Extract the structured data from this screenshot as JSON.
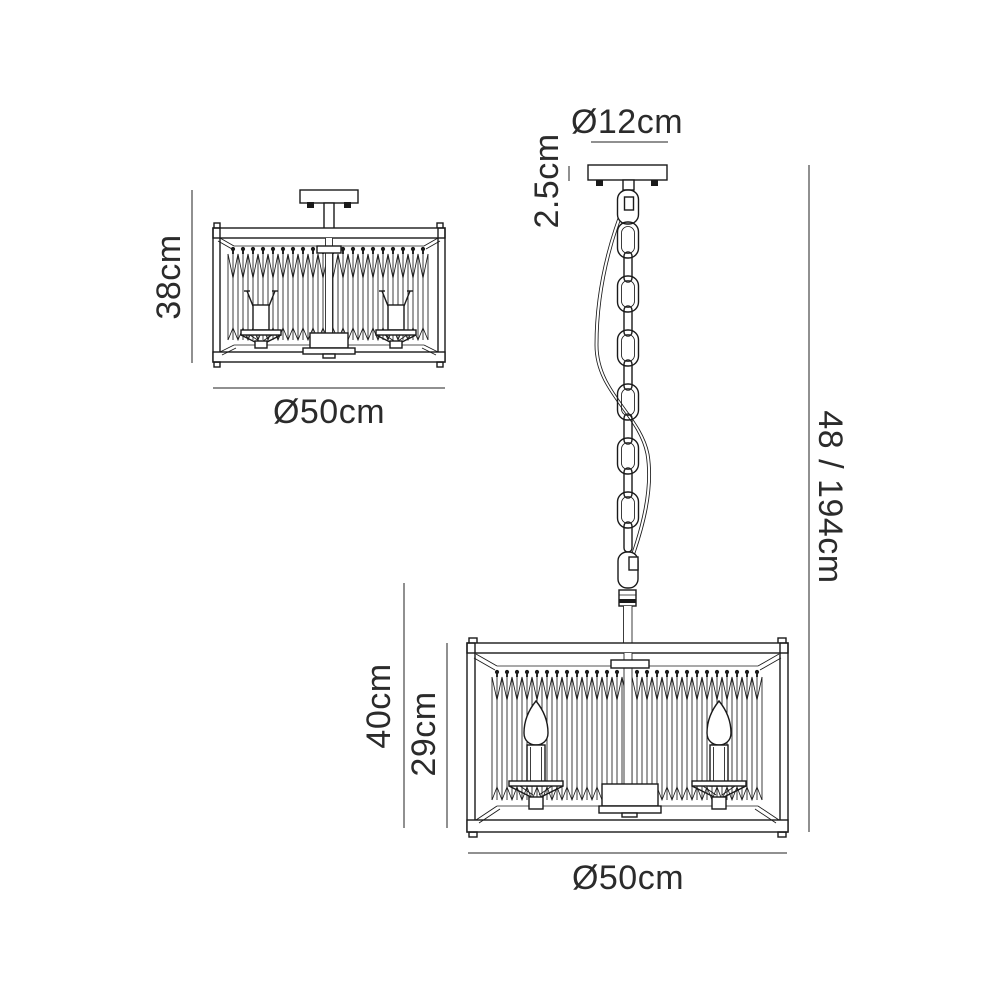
{
  "diagram": {
    "semi_flush": {
      "height": "38cm",
      "width": "Ø50cm"
    },
    "pendant": {
      "canopy_diameter": "Ø12cm",
      "canopy_height": "2.5cm",
      "overall_drop": "48 / 194cm",
      "fixture_height": "40cm",
      "shade_height": "29cm",
      "width": "Ø50cm"
    },
    "colors": {
      "background": "#ffffff",
      "line": "#1a1a1a",
      "dimension": "#4d4d4d",
      "text": "#2b2b2b"
    }
  }
}
